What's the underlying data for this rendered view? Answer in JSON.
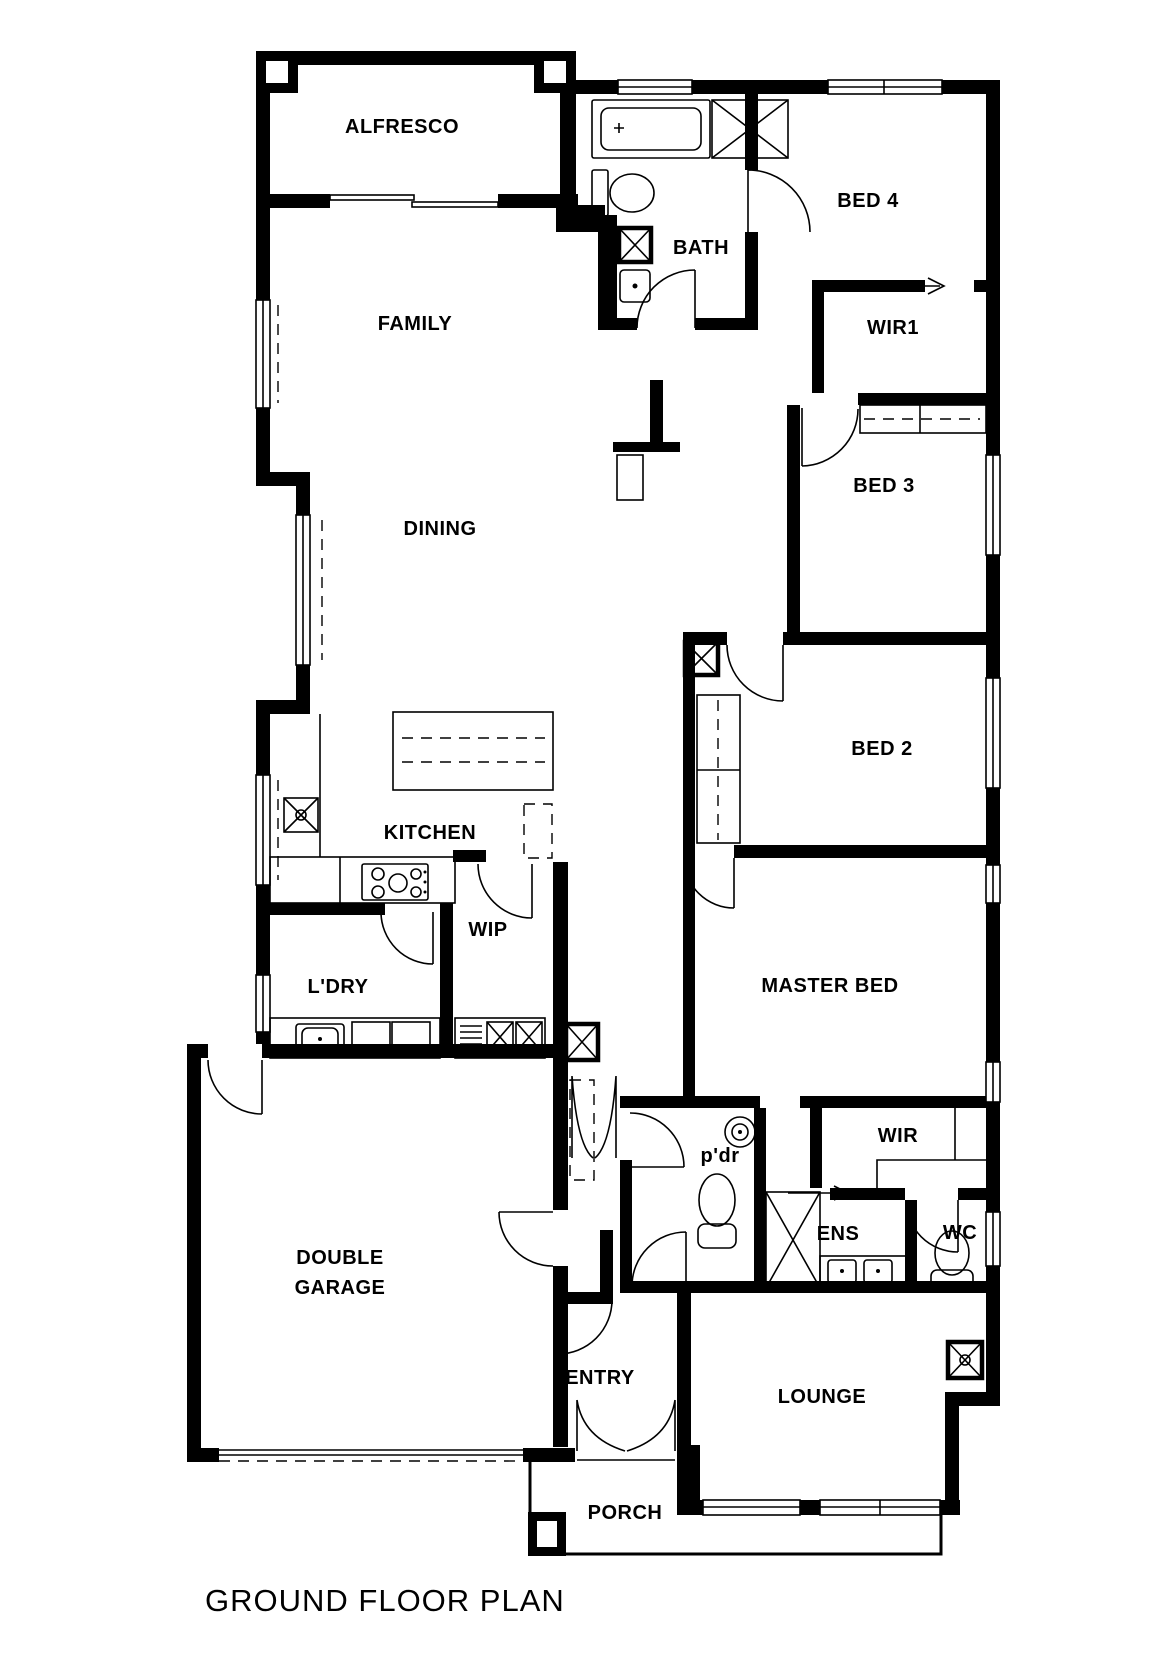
{
  "title": "GROUND FLOOR PLAN",
  "colors": {
    "wall": "#000000",
    "background": "#ffffff",
    "line": "#000000"
  },
  "rooms": [
    {
      "name": "alfresco",
      "text": "ALFRESCO",
      "x": 402,
      "y": 133
    },
    {
      "name": "bath",
      "text": "BATH",
      "x": 701,
      "y": 254
    },
    {
      "name": "bed-4",
      "text": "BED 4",
      "x": 868,
      "y": 207
    },
    {
      "name": "wir1",
      "text": "WIR1",
      "x": 893,
      "y": 334
    },
    {
      "name": "family",
      "text": "FAMILY",
      "x": 415,
      "y": 330
    },
    {
      "name": "dining",
      "text": "DINING",
      "x": 440,
      "y": 535
    },
    {
      "name": "bed-3",
      "text": "BED 3",
      "x": 884,
      "y": 492
    },
    {
      "name": "bed-2",
      "text": "BED 2",
      "x": 882,
      "y": 755
    },
    {
      "name": "kitchen",
      "text": "KITCHEN",
      "x": 430,
      "y": 839
    },
    {
      "name": "ldry",
      "text": "L'DRY",
      "x": 338,
      "y": 993
    },
    {
      "name": "wip",
      "text": "WIP",
      "x": 488,
      "y": 936
    },
    {
      "name": "master-bed",
      "text": "MASTER BED",
      "x": 830,
      "y": 992
    },
    {
      "name": "pdr",
      "text": "p'dr",
      "x": 720,
      "y": 1162,
      "fs": 18
    },
    {
      "name": "wir",
      "text": "WIR",
      "x": 898,
      "y": 1142
    },
    {
      "name": "ens",
      "text": "ENS",
      "x": 838,
      "y": 1240
    },
    {
      "name": "wc",
      "text": "WC",
      "x": 960,
      "y": 1239
    },
    {
      "name": "garage-line-1",
      "text": "DOUBLE",
      "x": 340,
      "y": 1264
    },
    {
      "name": "garage-line-2",
      "text": "GARAGE",
      "x": 340,
      "y": 1294
    },
    {
      "name": "entry",
      "text": "ENTRY",
      "x": 600,
      "y": 1384
    },
    {
      "name": "lounge",
      "text": "LOUNGE",
      "x": 822,
      "y": 1403
    },
    {
      "name": "porch",
      "text": "PORCH",
      "x": 625,
      "y": 1519
    }
  ]
}
